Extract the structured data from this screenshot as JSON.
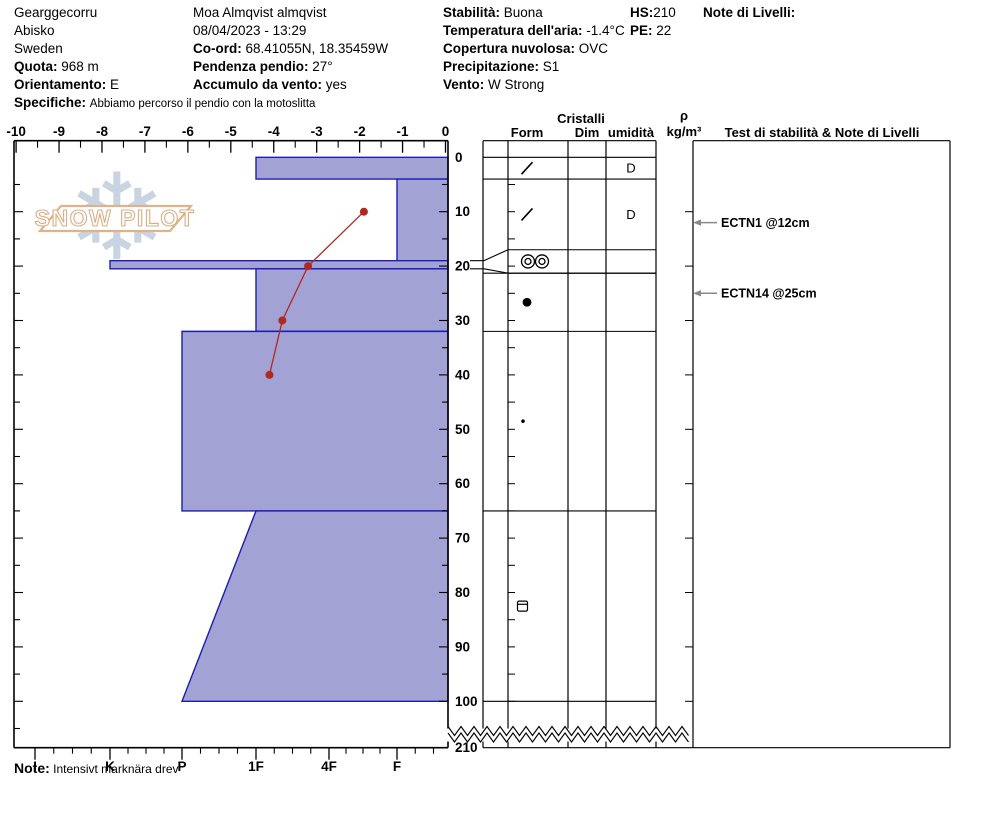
{
  "header": {
    "site": "Gearggecorru",
    "region": "Abisko",
    "country": "Sweden",
    "quota_label": "Quota:",
    "quota_value": "968 m",
    "orientamento_label": "Orientamento:",
    "orientamento_value": "E",
    "specifiche_label": "Specifiche:",
    "specifiche_value": "Abbiamo percorso il pendio con la motoslitta",
    "observer": "Moa Almqvist almqvist",
    "datetime": "08/04/2023 - 13:29",
    "coord_label": "Co-ord:",
    "coord_value": "68.41055N, 18.35459W",
    "pendenza_label": "Pendenza pendio:",
    "pendenza_value": "27°",
    "accumulo_label": "Accumulo da vento:",
    "accumulo_value": "yes",
    "stabilita_label": "Stabilità:",
    "stabilita_value": "Buona",
    "temperatura_label": "Temperatura dell'aria:",
    "temperatura_value": "-1.4°C",
    "copertura_label": "Copertura nuvolosa:",
    "copertura_value": "OVC",
    "precipitazione_label": "Precipitazione:",
    "precipitazione_value": "S1",
    "vento_label": "Vento:",
    "vento_value": "W Strong",
    "hs_label": "HS:",
    "hs_value": "210",
    "pe_label": "PE:",
    "pe_value": "22",
    "note_livelli_label": "Note di Livelli:"
  },
  "watermark": {
    "flake": "❄",
    "text": "SNOW PILOT"
  },
  "table_headers": {
    "cristalli": "Cristalli",
    "form": "Form",
    "dim": "Dim",
    "umidita": "umidità",
    "rho": "ρ",
    "rho_units": "kg/m³",
    "test": "Test di stabilità & Note di Livelli"
  },
  "note": {
    "label": "Note:",
    "text": "Intensivt marknära drev"
  },
  "chart_data": {
    "type": "snow-profile",
    "temp_axis": {
      "position": "top",
      "min": -10,
      "max": 0,
      "ticks": [
        -10,
        -9,
        -8,
        -7,
        -6,
        -5,
        -4,
        -3,
        -2,
        -1,
        0
      ]
    },
    "hardness_axis": {
      "position": "bottom",
      "categories": [
        "I",
        "K",
        "P",
        "1F",
        "4F",
        "F"
      ]
    },
    "depth_axis": {
      "position": "right",
      "unit": "cm",
      "ticks": [
        0,
        10,
        20,
        30,
        40,
        50,
        60,
        70,
        80,
        90,
        100
      ],
      "break_after": 100,
      "ground_label": "210",
      "total_depth": 210
    },
    "layers": [
      {
        "top": 0,
        "bottom": 4,
        "hardness": "1F",
        "form": "df-slash",
        "wetness": "D"
      },
      {
        "top": 4,
        "bottom": 19,
        "hardness": "F",
        "form": "df-slash",
        "wetness": "D"
      },
      {
        "top": 19,
        "bottom": 20.5,
        "hardness": "K",
        "form": "mfcr-double-circle",
        "wetness": ""
      },
      {
        "top": 20.5,
        "bottom": 32,
        "hardness": "1F",
        "form": "rg-dot",
        "wetness": ""
      },
      {
        "top": 32,
        "bottom": 65,
        "hardness": "P",
        "form": "rg-dot-small",
        "wetness": ""
      },
      {
        "top": 65,
        "bottom": 100,
        "hardness": "1F",
        "hardness_bottom": "P",
        "form": "fc-square-lined",
        "wetness": ""
      }
    ],
    "temperature_profile": [
      {
        "depth": 10,
        "temp": -1.9
      },
      {
        "depth": 20,
        "temp": -3.2
      },
      {
        "depth": 30,
        "temp": -3.8
      },
      {
        "depth": 40,
        "temp": -4.1
      }
    ],
    "stability_tests": [
      {
        "label": "ECTN1 @12cm",
        "depth": 12
      },
      {
        "label": "ECTN14 @25cm",
        "depth": 25
      }
    ],
    "colors": {
      "layer_fill": "#a2a2d4",
      "layer_stroke": "#1c1cb4",
      "temp_line": "#b02820",
      "axis": "#000000",
      "arrow": "#8a8a8a",
      "watermark_tan": "#dcb48c",
      "watermark_flake": "#c9d4e3"
    }
  }
}
